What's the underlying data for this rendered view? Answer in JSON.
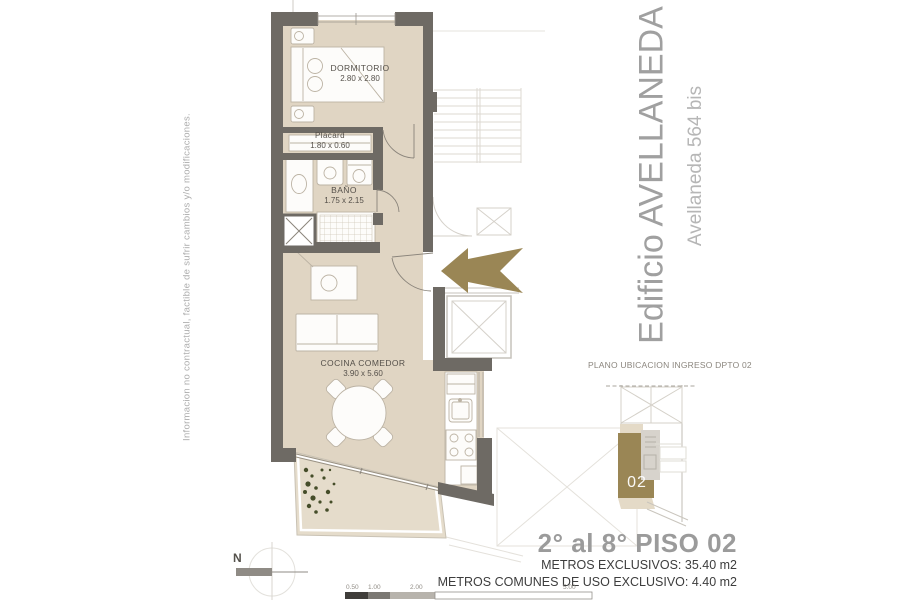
{
  "disclaimer": "Informacion no contractual, factible de sufrir cambios y/o modificaciones.",
  "building": {
    "title": "Edificio AVELLANEDA",
    "subtitle": "Avellaneda 564 bis"
  },
  "rooms": {
    "dormitorio": {
      "name": "DORMITORIO",
      "dims": "2.80 x 2.80"
    },
    "placard": {
      "name": "Placard",
      "dims": "1.80 x 0.60"
    },
    "bano": {
      "name": "BAÑO",
      "dims": "1.75 x 2.15"
    },
    "cocina": {
      "name": "COCINA COMEDOR",
      "dims": "3.90 x 5.60"
    }
  },
  "location_plan": {
    "title": "PLANO UBICACION INGRESO DPTO 02",
    "unit_label": "02"
  },
  "summary": {
    "floor_title": "2° al 8° PISO 02",
    "metros_exclusivos": "METROS EXCLUSIVOS: 35.40 m2",
    "metros_comunes": "METROS COMUNES DE USO EXCLUSIVO: 4.40 m2"
  },
  "compass": {
    "north_label": "N"
  },
  "scale": {
    "ticks": [
      "0.50",
      "1.00",
      "2.00",
      "5.00"
    ]
  },
  "colors": {
    "wall": "#6e6a64",
    "floor": "#e0d5c3",
    "balcony_floor": "#e5dccb",
    "accent_olive": "#9a8655",
    "title_gray": "#a0a0a0",
    "light_line": "#dcd9d2"
  }
}
